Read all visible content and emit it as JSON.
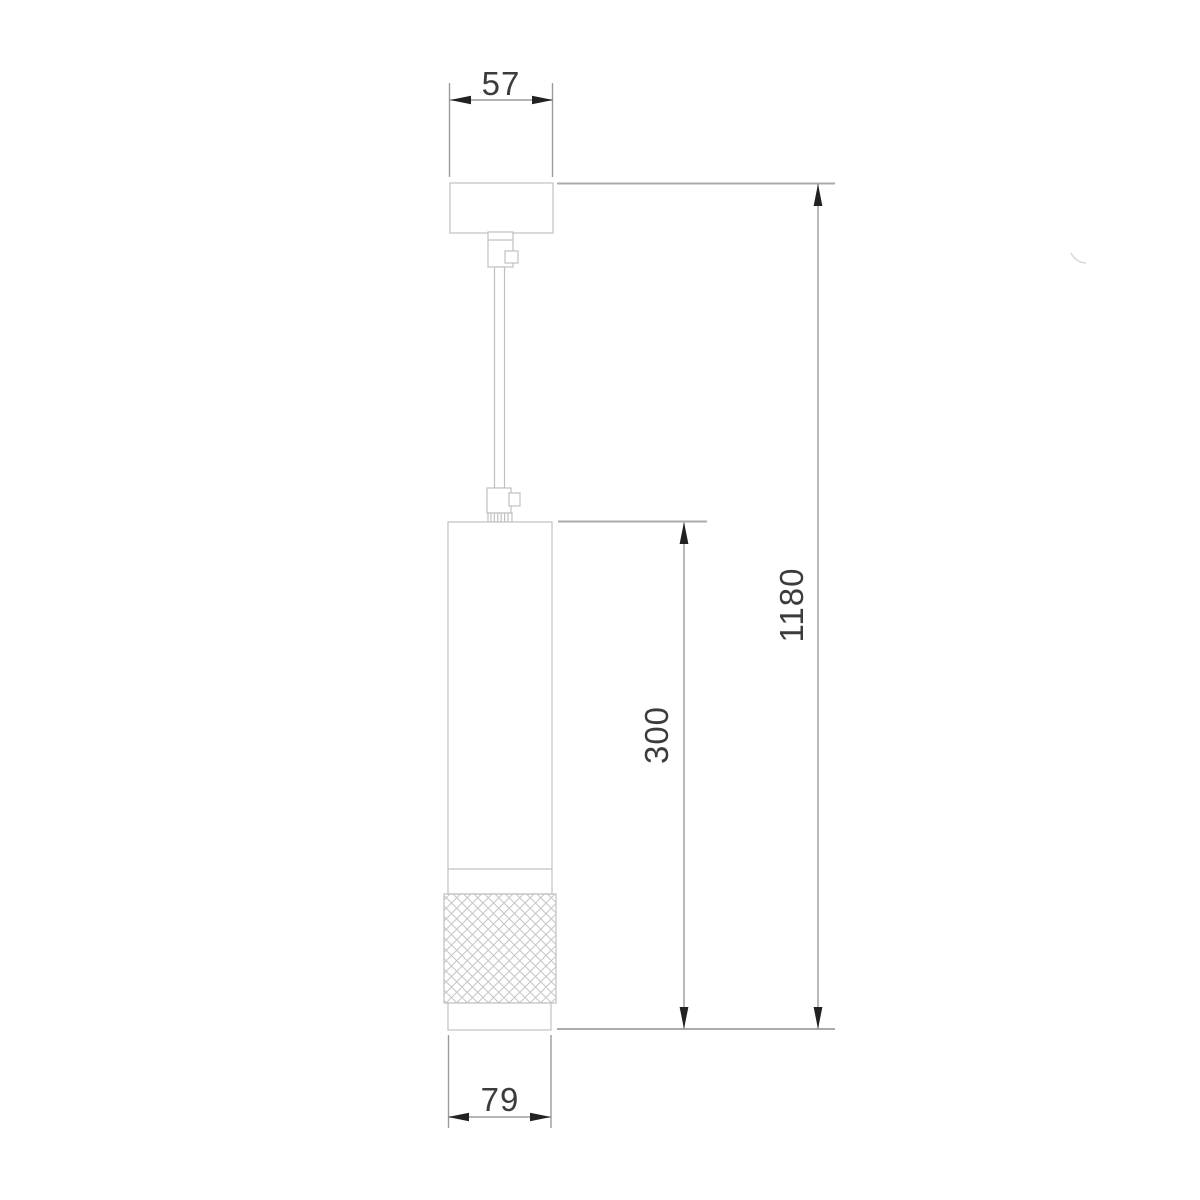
{
  "drawing": {
    "type": "technical-dimension-drawing",
    "subject": "pendant-ceiling-lamp-side-view",
    "labels": {
      "canopy_width_mm": "57",
      "overall_drop_mm": "1180",
      "body_height_mm": "300",
      "body_diameter_mm": "79"
    },
    "colors": {
      "background": "#ffffff",
      "outline": "#c0c0c0",
      "knurl_hatch": "#c6c6c6",
      "extension_line": "#ababab",
      "dimension_line": "#9b9b9b",
      "arrow": "#222222",
      "text": "#3c3c3c",
      "artifact": "#d9d9d9"
    },
    "parts": [
      {
        "name": "ceiling-canopy"
      },
      {
        "name": "top-cord-grip"
      },
      {
        "name": "suspension-stem"
      },
      {
        "name": "bottom-cord-grip"
      },
      {
        "name": "threaded-collar"
      },
      {
        "name": "cylindrical-lamp-body"
      },
      {
        "name": "knurled-grip-ring"
      },
      {
        "name": "bottom-trim-ring"
      }
    ]
  }
}
